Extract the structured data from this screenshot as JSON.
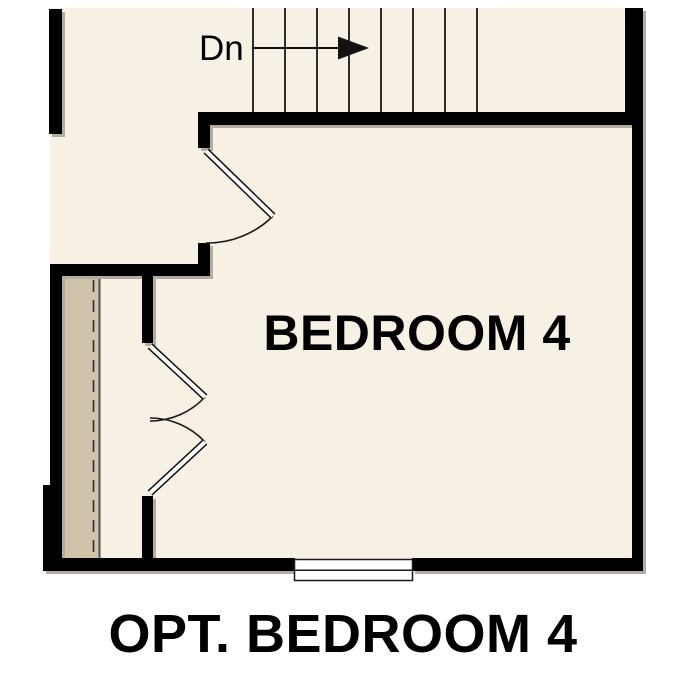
{
  "plan": {
    "room_label": "BEDROOM 4",
    "stair_label": "Dn",
    "caption": "OPT. BEDROOM 4"
  },
  "colors": {
    "background": "#ffffff",
    "floor": "#f7f0e5",
    "closet_floor": "#cfc4ab",
    "wall": "#000000",
    "wall_shadow": "#b3aca0",
    "line": "#2d2d2d",
    "text": "#000000",
    "door_panel": "#ffffff",
    "window": "#ffffff"
  }
}
